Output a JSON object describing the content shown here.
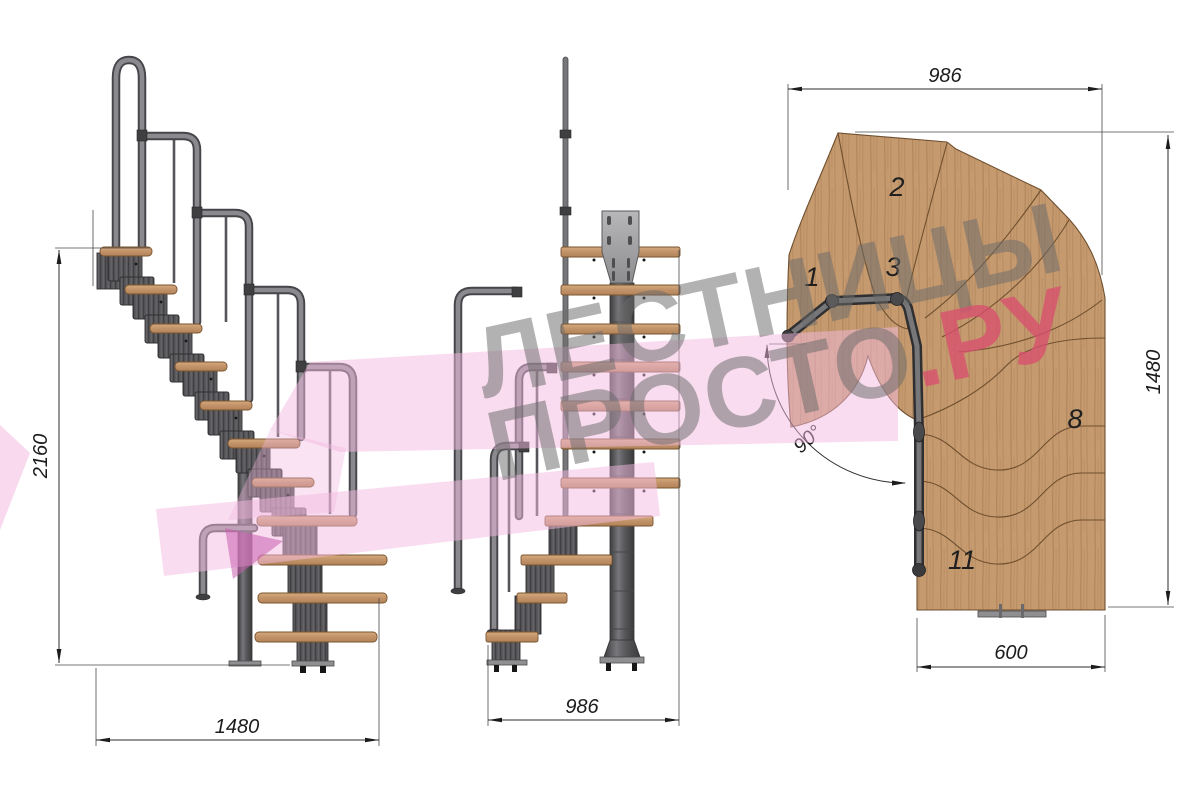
{
  "watermark": {
    "line1": "ЛЕСТНИЦЫ",
    "line2": "ПРОСТО",
    "line2_accent": ".РУ",
    "text_color": "#6c6c6c",
    "accent_color": "#d94f6e",
    "ribbon_color": "#f3b9e0"
  },
  "views": {
    "side": {
      "label": "side-elevation",
      "dim_height": "2160",
      "dim_length": "1480"
    },
    "front": {
      "label": "front-elevation",
      "dim_width": "986"
    },
    "plan": {
      "label": "top-plan",
      "dim_width": "986",
      "dim_length": "1480",
      "dim_run_width": "600",
      "dim_turn_angle": "90°",
      "step_numbers": [
        "1",
        "2",
        "3",
        "8",
        "11"
      ]
    }
  },
  "colors": {
    "wood": "#c59a6f",
    "wood_edge": "#7a5430",
    "metal": "#57575a",
    "metal_dark": "#3f3f41",
    "dim_line": "#2b2b2b",
    "background": "#ffffff"
  }
}
